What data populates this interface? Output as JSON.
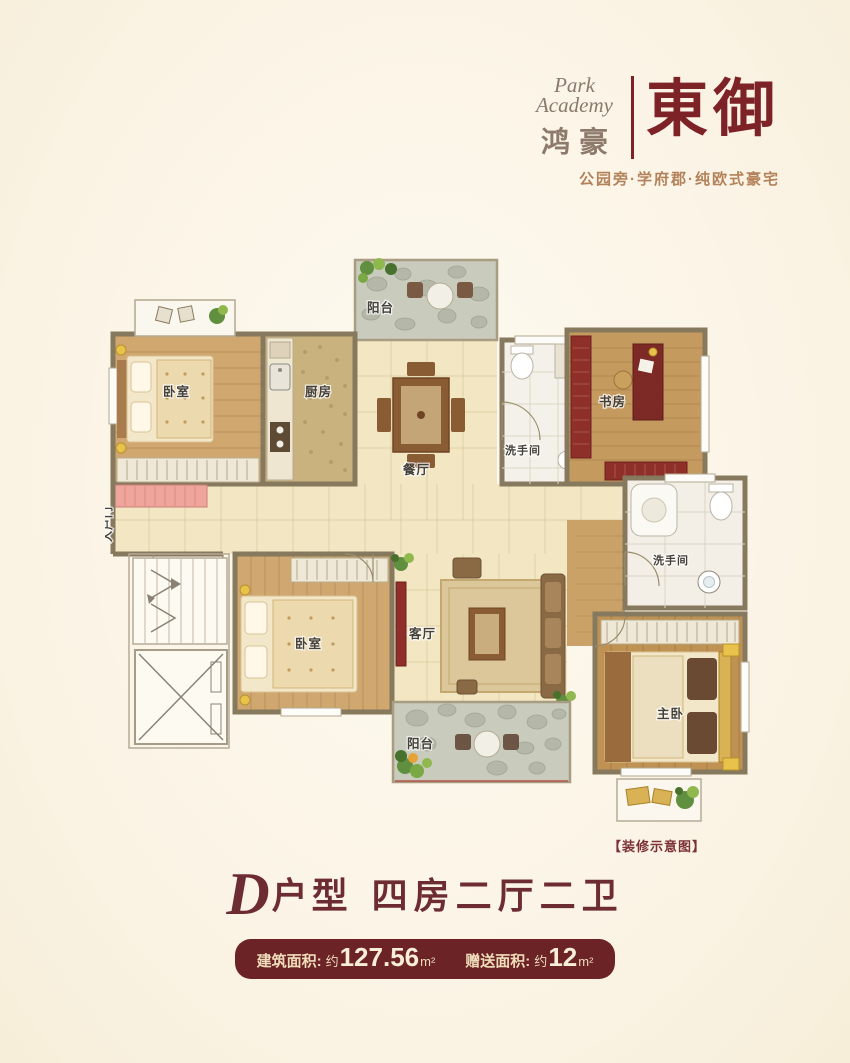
{
  "brand": {
    "name_en_line1": "Park",
    "name_en_line2": "Academy",
    "name_cn": "鸿豪",
    "project_name": "東御",
    "tagline": "公园旁·学府郡·纯欧式豪宅"
  },
  "plan": {
    "watermark": "【装修示意图】",
    "entry_label": "入户门",
    "rooms": {
      "balcony_top": "阳台",
      "bedroom_top": "卧室",
      "kitchen": "厨房",
      "dining": "餐厅",
      "bath_top": "洗手间",
      "study": "书房",
      "bath_right": "洗手间",
      "living": "客厅",
      "bedroom_mid": "卧室",
      "master": "主卧",
      "balcony_bottom": "阳台"
    }
  },
  "footer": {
    "unit_letter": "D",
    "unit_suffix": "户型",
    "unit_desc": "四房二厅二卫",
    "areas": [
      {
        "label": "建筑面积:",
        "approx": "约",
        "value": "127.56",
        "unit": "m²"
      },
      {
        "label": "赠送面积:",
        "approx": "约",
        "value": "12",
        "unit": "m²"
      }
    ]
  },
  "colors": {
    "accent_red": "#7d2226",
    "badge_bg": "#6b2325",
    "tagline_brown": "#b3825a",
    "wall": "#87795e",
    "wood": "#cfa76f",
    "tile": "#f2e6c3",
    "stone": "#c7c9ba",
    "background": "#fbf4e6"
  }
}
